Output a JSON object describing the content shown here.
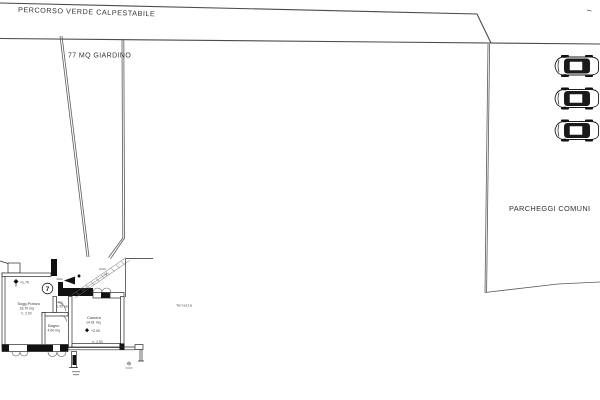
{
  "site": {
    "walkway_label": "PERCORSO VERDE CALPESTABILE",
    "garden_label": "77 MQ GIARDINO",
    "parking_label": "PARCHEGGI COMUNI",
    "parking_car_count": 3
  },
  "apartment": {
    "unit_number": "7",
    "levels": {
      "entry": "+1.70",
      "bedroom": "+2.00"
    },
    "rooms": {
      "living": {
        "name": "Sogg.Pranzo",
        "area": "18.70 mq",
        "height": "h. 2.90"
      },
      "entry": {
        "name": "Ing.",
        "area": "1.99 mq"
      },
      "bath": {
        "name": "Bagno",
        "area": "4.60 mq"
      },
      "bedroom": {
        "name": "Camera",
        "area": "14.01 mq",
        "height": "h. 2.90"
      },
      "terrace": {
        "name": "Terrazza"
      }
    }
  },
  "colors": {
    "line": "#4a4a4a",
    "wall": "#111111",
    "text": "#3a3a3a"
  }
}
